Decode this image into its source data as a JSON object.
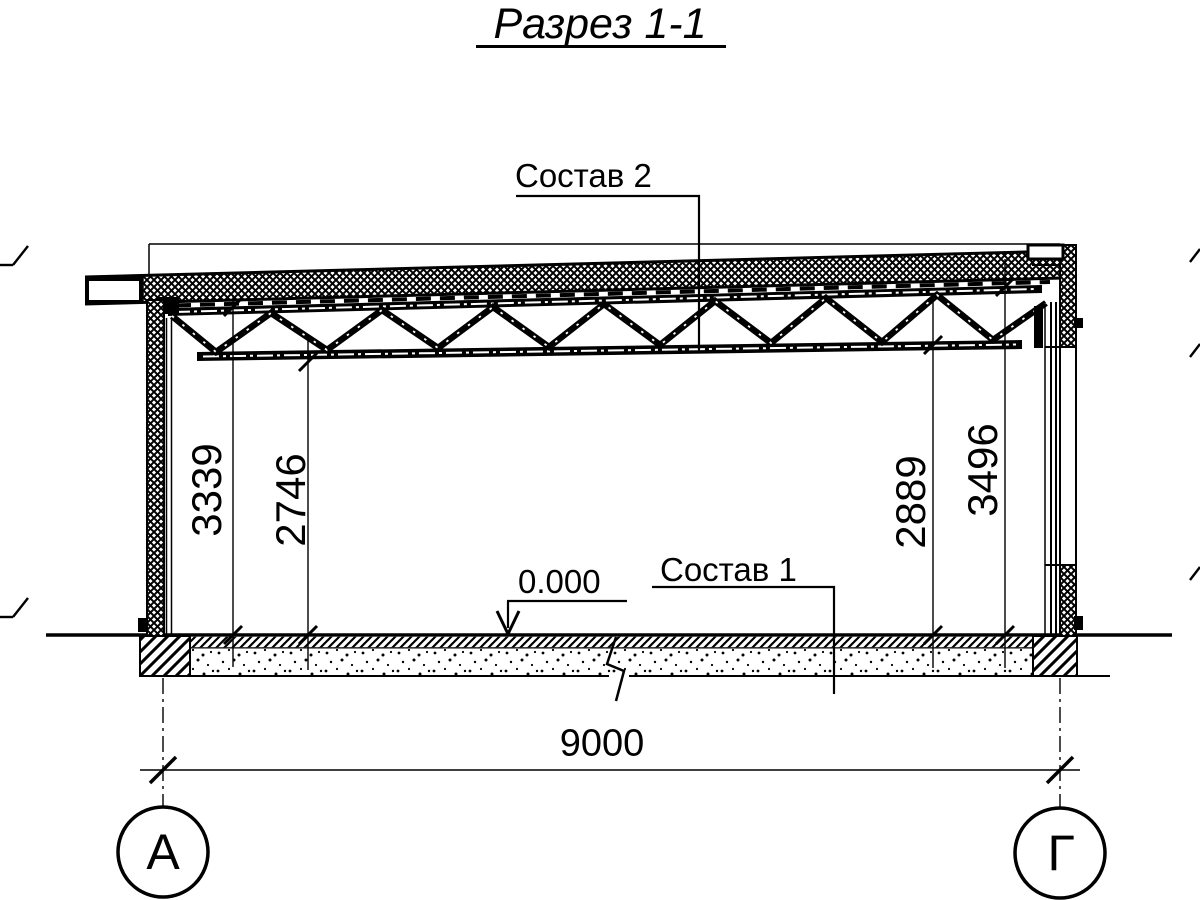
{
  "title": "Разрез 1-1",
  "callouts": {
    "roof_composition": "Состав 2",
    "floor_composition": "Состав 1"
  },
  "level_mark": "0.000",
  "dimensions": {
    "overall_width": "9000",
    "left_truss_top": "3339",
    "left_truss_bottom": "2746",
    "right_truss_bottom": "2889",
    "right_truss_top": "3496"
  },
  "axis_labels": {
    "left": "А",
    "right": "Г"
  },
  "colors": {
    "ink": "#000000",
    "paper": "#ffffff"
  }
}
